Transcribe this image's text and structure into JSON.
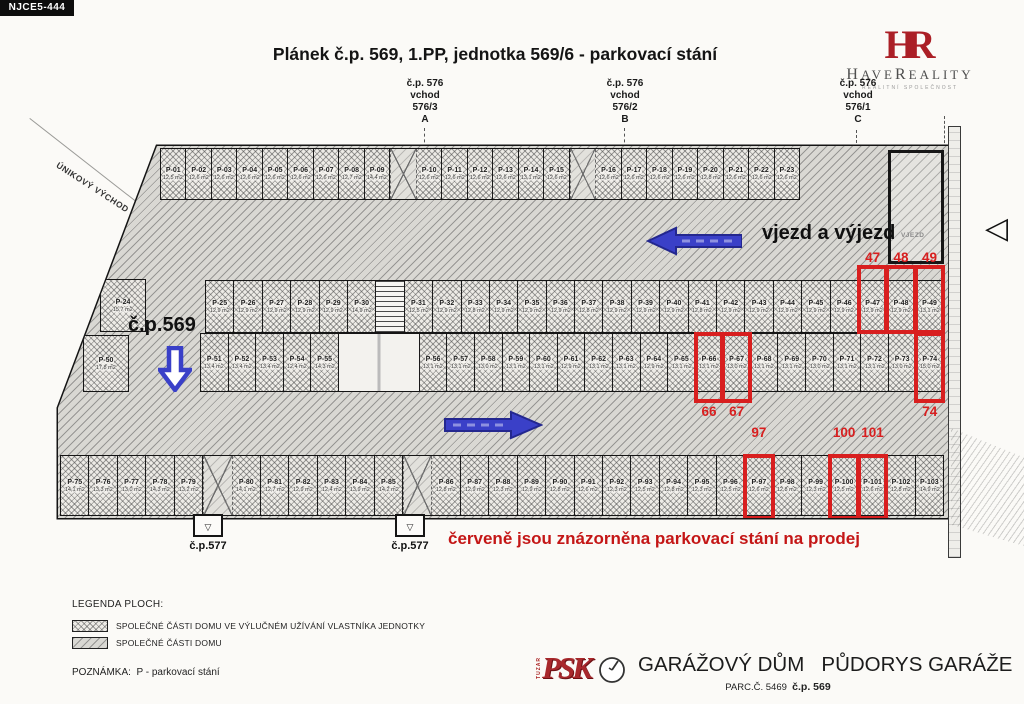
{
  "stamp": "NJCE5-444",
  "title": "Plánek č.p. 569, 1.PP, jednotka 569/6 - parkovací stání",
  "logo": {
    "monogram": "HR",
    "name_h": "H",
    "name_ave": "AVE",
    "name_r": "R",
    "name_eality": "EALITY",
    "tagline": "REALITNÍ SPOLEČNOST"
  },
  "entrances": [
    {
      "cp": "č.p. 576",
      "vchod": "vchod",
      "num": "576/3",
      "letter": "A"
    },
    {
      "cp": "č.p. 576",
      "vchod": "vchod",
      "num": "576/2",
      "letter": "B"
    },
    {
      "cp": "č.p. 576",
      "vchod": "vchod",
      "num": "576/1",
      "letter": "C"
    }
  ],
  "labels": {
    "unikovy_vychod": "ÚNIKOVÝ VÝCHOD",
    "vjezd_a_vyjezd": "vjezd a výjezd",
    "vjezd_small": "VJEZD",
    "cp569": "č.p.569",
    "cp577_left": "č.p.577",
    "cp577_mid": "č.p.577",
    "exit_glyph": "▽",
    "triangle_glyph": "◁",
    "sale_note": "červeně jsou znázorněna parkovací stání na prodej"
  },
  "legend": {
    "title": "LEGENDA PLOCH:",
    "items": [
      {
        "label": "SPOLEČNÉ ČÁSTI DOMU VE VÝLUČNÉM UŽÍVÁNÍ VLASTNÍKA JEDNOTKY"
      },
      {
        "label": "SPOLEČNÉ ČÁSTI DOMU"
      }
    ],
    "note_title": "POZNÁMKA:",
    "note_text": "P - parkovací stání"
  },
  "titleblock": {
    "logo_side": "TUZAR",
    "logo_text": "PSK",
    "title1": "GARÁŽOVÝ DŮM",
    "title2": "PŮDORYS GARÁŽE",
    "parc": "PARC.Č. 5469",
    "cp": "č.p. 569"
  },
  "colors": {
    "sale_red": "#d81f1f",
    "note_red": "#c41616",
    "arrow_blue": "#3a40c8",
    "logo_red": "#ab1f26"
  },
  "rows": {
    "row1": [
      {
        "id": "P-01",
        "area": "12,5 m2"
      },
      {
        "id": "P-02",
        "area": "12,6 m2"
      },
      {
        "id": "P-03",
        "area": "12,6 m2"
      },
      {
        "id": "P-04",
        "area": "12,6 m2"
      },
      {
        "id": "P-05",
        "area": "12,6 m2"
      },
      {
        "id": "P-06",
        "area": "12,6 m2"
      },
      {
        "id": "P-07",
        "area": "12,6 m2"
      },
      {
        "id": "P-08",
        "area": "12,7 m2"
      },
      {
        "id": "P-09",
        "area": "14,4 m2"
      },
      {
        "t": "gap"
      },
      {
        "id": "P-10",
        "area": "12,6 m2"
      },
      {
        "id": "P-11",
        "area": "12,6 m2"
      },
      {
        "id": "P-12",
        "area": "12,6 m2"
      },
      {
        "id": "P-13",
        "area": "12,6 m2"
      },
      {
        "id": "P-14",
        "area": "13,1 m2"
      },
      {
        "id": "P-15",
        "area": "12,6 m2"
      },
      {
        "t": "gap"
      },
      {
        "id": "P-16",
        "area": "12,6 m2"
      },
      {
        "id": "P-17",
        "area": "12,6 m2"
      },
      {
        "id": "P-18",
        "area": "12,6 m2"
      },
      {
        "id": "P-19",
        "area": "12,6 m2"
      },
      {
        "id": "P-20",
        "area": "12,8 m2"
      },
      {
        "id": "P-21",
        "area": "12,6 m2"
      },
      {
        "id": "P-22",
        "area": "12,6 m2"
      },
      {
        "id": "P-23",
        "area": "12,6 m2"
      }
    ],
    "spot24": [
      {
        "id": "P-24",
        "area": "15,7 m2"
      }
    ],
    "row2": [
      {
        "id": "P-25",
        "area": "12,9 m2"
      },
      {
        "id": "P-26",
        "area": "12,9 m2"
      },
      {
        "id": "P-27",
        "area": "12,9 m2"
      },
      {
        "id": "P-28",
        "area": "12,9 m2"
      },
      {
        "id": "P-29",
        "area": "12,9 m2"
      },
      {
        "id": "P-30",
        "area": "14,9 m2"
      },
      {
        "t": "stair"
      },
      {
        "id": "P-31",
        "area": "12,5 m2"
      },
      {
        "id": "P-32",
        "area": "12,9 m2"
      },
      {
        "id": "P-33",
        "area": "12,8 m2"
      },
      {
        "id": "P-34",
        "area": "12,9 m2"
      },
      {
        "id": "P-35",
        "area": "12,9 m2"
      },
      {
        "id": "P-36",
        "area": "12,9 m2"
      },
      {
        "id": "P-37",
        "area": "12,8 m2"
      },
      {
        "id": "P-38",
        "area": "12,9 m2"
      },
      {
        "id": "P-39",
        "area": "12,9 m2"
      },
      {
        "id": "P-40",
        "area": "12,9 m2"
      },
      {
        "id": "P-41",
        "area": "12,8 m2"
      },
      {
        "id": "P-42",
        "area": "12,9 m2"
      },
      {
        "id": "P-43",
        "area": "12,9 m2"
      },
      {
        "id": "P-44",
        "area": "12,9 m2"
      },
      {
        "id": "P-45",
        "area": "12,9 m2"
      },
      {
        "id": "P-46",
        "area": "12,9 m2"
      },
      {
        "id": "P-47",
        "area": "12,9 m2",
        "sale": true,
        "num": "47",
        "label": "above",
        "ext": "ext-up"
      },
      {
        "id": "P-48",
        "area": "12,9 m2",
        "sale": true,
        "num": "48",
        "label": "above",
        "ext": "ext-up"
      },
      {
        "id": "P-49",
        "area": "13,1 m2",
        "sale": true,
        "num": "49",
        "label": "above",
        "ext": "ext-up"
      }
    ],
    "spot50": [
      {
        "id": "P-50",
        "area": "17,8 m2"
      }
    ],
    "row3": [
      {
        "id": "P-51",
        "area": "13,4 m2"
      },
      {
        "id": "P-52",
        "area": "13,4 m2"
      },
      {
        "id": "P-53",
        "area": "13,4 m2"
      },
      {
        "id": "P-54",
        "area": "12,4 m2"
      },
      {
        "id": "P-55",
        "area": "14,3 m2"
      },
      {
        "t": "lobby"
      },
      {
        "id": "P-56",
        "area": "13,1 m2"
      },
      {
        "id": "P-57",
        "area": "13,1 m2"
      },
      {
        "id": "P-58",
        "area": "13,0 m2"
      },
      {
        "id": "P-59",
        "area": "13,1 m2"
      },
      {
        "id": "P-60",
        "area": "13,1 m2"
      },
      {
        "id": "P-61",
        "area": "12,9 m2"
      },
      {
        "id": "P-62",
        "area": "13,1 m2"
      },
      {
        "id": "P-63",
        "area": "13,1 m2"
      },
      {
        "id": "P-64",
        "area": "12,9 m2"
      },
      {
        "id": "P-65",
        "area": "13,1 m2"
      },
      {
        "id": "P-66",
        "area": "13,1 m2",
        "sale": true,
        "num": "66",
        "label": "below",
        "ext": "ext-down"
      },
      {
        "id": "P-67",
        "area": "13,0 m2",
        "sale": true,
        "num": "67",
        "label": "below",
        "ext": "ext-down"
      },
      {
        "id": "P-68",
        "area": "13,1 m2"
      },
      {
        "id": "P-69",
        "area": "13,1 m2"
      },
      {
        "id": "P-70",
        "area": "13,0 m2"
      },
      {
        "id": "P-71",
        "area": "13,1 m2"
      },
      {
        "id": "P-72",
        "area": "13,1 m2"
      },
      {
        "id": "P-73",
        "area": "13,0 m2"
      },
      {
        "id": "P-74",
        "area": "15,0 m2",
        "sale": true,
        "num": "74",
        "label": "below",
        "ext": "ext-down"
      }
    ],
    "row4": [
      {
        "id": "P-75",
        "area": "14,1 m2"
      },
      {
        "id": "P-76",
        "area": "13,3 m2"
      },
      {
        "id": "P-77",
        "area": "13,0 m2"
      },
      {
        "id": "P-78",
        "area": "14,3 m2"
      },
      {
        "id": "P-79",
        "area": "13,2 m2"
      },
      {
        "t": "gap"
      },
      {
        "id": "P-80",
        "area": "14,1 m2"
      },
      {
        "id": "P-81",
        "area": "12,7 m2"
      },
      {
        "id": "P-82",
        "area": "12,9 m2"
      },
      {
        "id": "P-83",
        "area": "12,4 m2"
      },
      {
        "id": "P-84",
        "area": "13,9 m2"
      },
      {
        "id": "P-85",
        "area": "14,2 m2"
      },
      {
        "t": "gap"
      },
      {
        "id": "P-86",
        "area": "12,8 m2"
      },
      {
        "id": "P-87",
        "area": "12,9 m2"
      },
      {
        "id": "P-88",
        "area": "12,3 m2"
      },
      {
        "id": "P-89",
        "area": "12,9 m2"
      },
      {
        "id": "P-90",
        "area": "12,8 m2"
      },
      {
        "id": "P-91",
        "area": "12,6 m2"
      },
      {
        "id": "P-92",
        "area": "12,3 m2"
      },
      {
        "id": "P-93",
        "area": "12,5 m2"
      },
      {
        "id": "P-94",
        "area": "12,8 m2"
      },
      {
        "id": "P-95",
        "area": "12,3 m2"
      },
      {
        "id": "P-96",
        "area": "12,5 m2"
      },
      {
        "id": "P-97",
        "area": "12,6 m2",
        "sale": true,
        "num": "97",
        "label": "above",
        "ext": "ext-down-sm"
      },
      {
        "id": "P-98",
        "area": "12,8 m2"
      },
      {
        "id": "P-99",
        "area": "12,3 m2"
      },
      {
        "id": "P-100",
        "area": "12,5 m2",
        "sale": true,
        "num": "100",
        "label": "above",
        "ext": "ext-down-sm"
      },
      {
        "id": "P-101",
        "area": "12,6 m2",
        "sale": true,
        "num": "101",
        "label": "above",
        "ext": "ext-down-sm"
      },
      {
        "id": "P-102",
        "area": "12,8 m2"
      },
      {
        "id": "P-103",
        "area": "14,9 m2"
      }
    ]
  }
}
